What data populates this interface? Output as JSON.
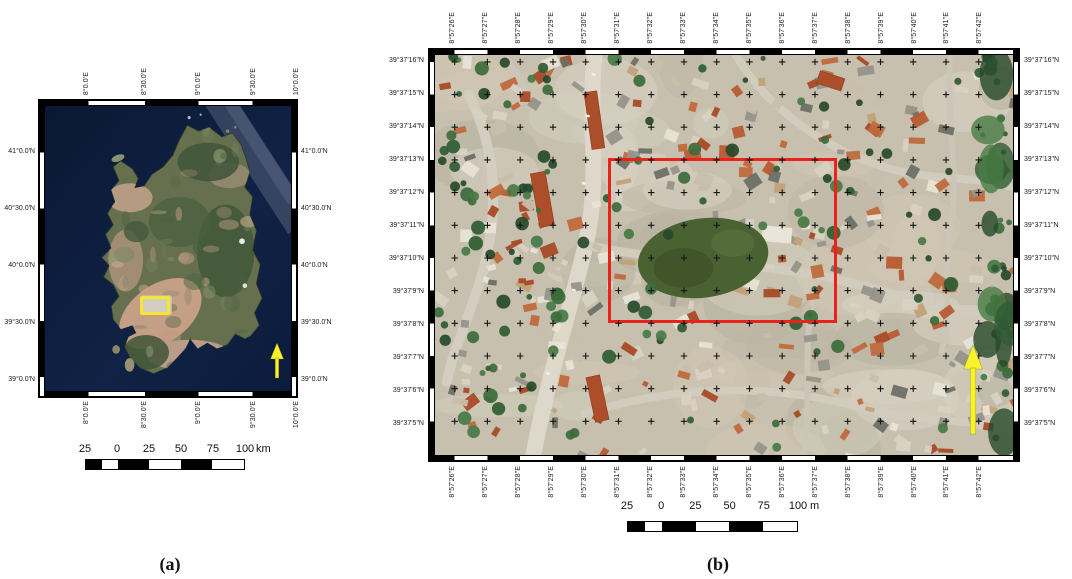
{
  "figure": {
    "panel_a": {
      "caption": "(a)",
      "lon_labels": [
        "8°0.0'E",
        "8°30.0'E",
        "9°0.0'E",
        "9°30.0'E",
        "10°0.0'E"
      ],
      "lat_labels": [
        "41°0.0'N",
        "40°30.0'N",
        "40°0.0'N",
        "39°30.0'N",
        "39°0.0'N"
      ],
      "scalebar": {
        "tick_labels": [
          "25",
          "0",
          "25",
          "50",
          "75",
          "100"
        ],
        "unit": "km"
      },
      "aoi_color": "#f2e832",
      "north_arrow_color": "#f8f22e",
      "sea_color": "#0d1c3c"
    },
    "panel_b": {
      "caption": "(b)",
      "lon_labels": [
        "8°57'26\"E",
        "8°57'27\"E",
        "8°57'28\"E",
        "8°57'29\"E",
        "8°57'30\"E",
        "8°57'31\"E",
        "8°57'32\"E",
        "8°57'33\"E",
        "8°57'34\"E",
        "8°57'35\"E",
        "8°57'36\"E",
        "8°57'37\"E",
        "8°57'38\"E",
        "8°57'39\"E",
        "8°57'40\"E",
        "8°57'41\"E",
        "8°57'42\"E"
      ],
      "lat_labels": [
        "39°37'16\"N",
        "39°37'15\"N",
        "39°37'14\"N",
        "39°37'13\"N",
        "39°37'12\"N",
        "39°37'11\"N",
        "39°37'10\"N",
        "39°37'9\"N",
        "39°37'8\"N",
        "39°37'7\"N",
        "39°37'6\"N",
        "39°37'5\"N"
      ],
      "scalebar": {
        "tick_labels": [
          "25",
          "0",
          "25",
          "50",
          "75",
          "100"
        ],
        "unit": "m"
      },
      "aoi_color": "#e8231c",
      "north_arrow_color": "#f8f22e"
    }
  }
}
